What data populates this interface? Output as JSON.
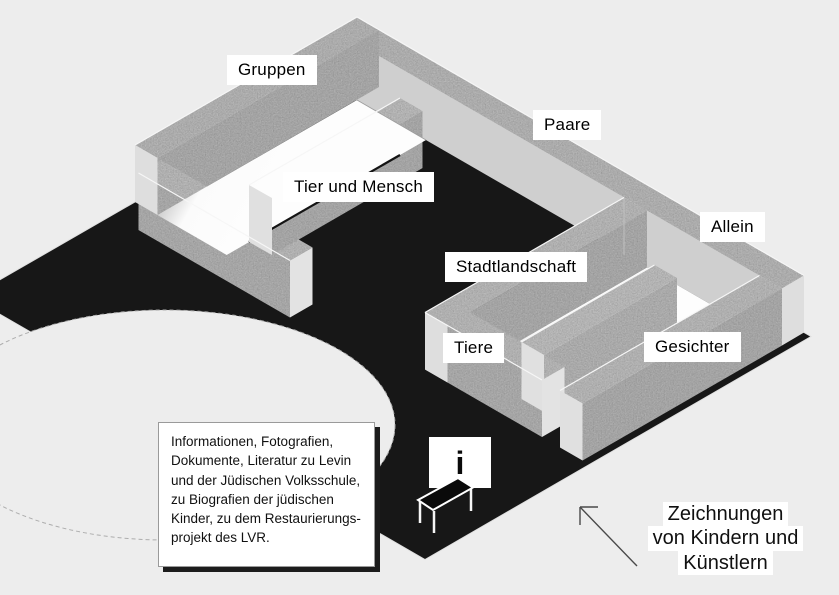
{
  "palette": {
    "background": "#ededed",
    "ground_floor": "#171717",
    "wall_texture": "#c4c4c4",
    "wall_inner_side": "#cfcfcf",
    "wall_top": "#d6d6d6",
    "wall_end_cap": "#dedede",
    "room_floor": "#fbfbfb",
    "label_background": "#ffffff",
    "text_color": "#000000"
  },
  "room_labels": [
    {
      "id": "gruppen",
      "text": "Gruppen"
    },
    {
      "id": "paare",
      "text": "Paare"
    },
    {
      "id": "tier_und_mensch",
      "text": "Tier und Mensch"
    },
    {
      "id": "allein",
      "text": "Allein"
    },
    {
      "id": "stadtlandschaft",
      "text": "Stadtlandschaft"
    },
    {
      "id": "tiere",
      "text": "Tiere"
    },
    {
      "id": "gesichter",
      "text": "Gesichter"
    }
  ],
  "info_box": {
    "lines": [
      "Informationen, Fotografien,",
      "Dokumente, Literatur zu Levin",
      "und der Jüdischen Volksschule,",
      "zu Biografien der jüdischen",
      "Kinder, zu dem Restaurierungs-",
      "projekt des LVR."
    ]
  },
  "info_sign": {
    "glyph": "i"
  },
  "annotation": {
    "lines": [
      "Zeichnungen",
      "von Kindern und",
      "Künstlern"
    ]
  }
}
